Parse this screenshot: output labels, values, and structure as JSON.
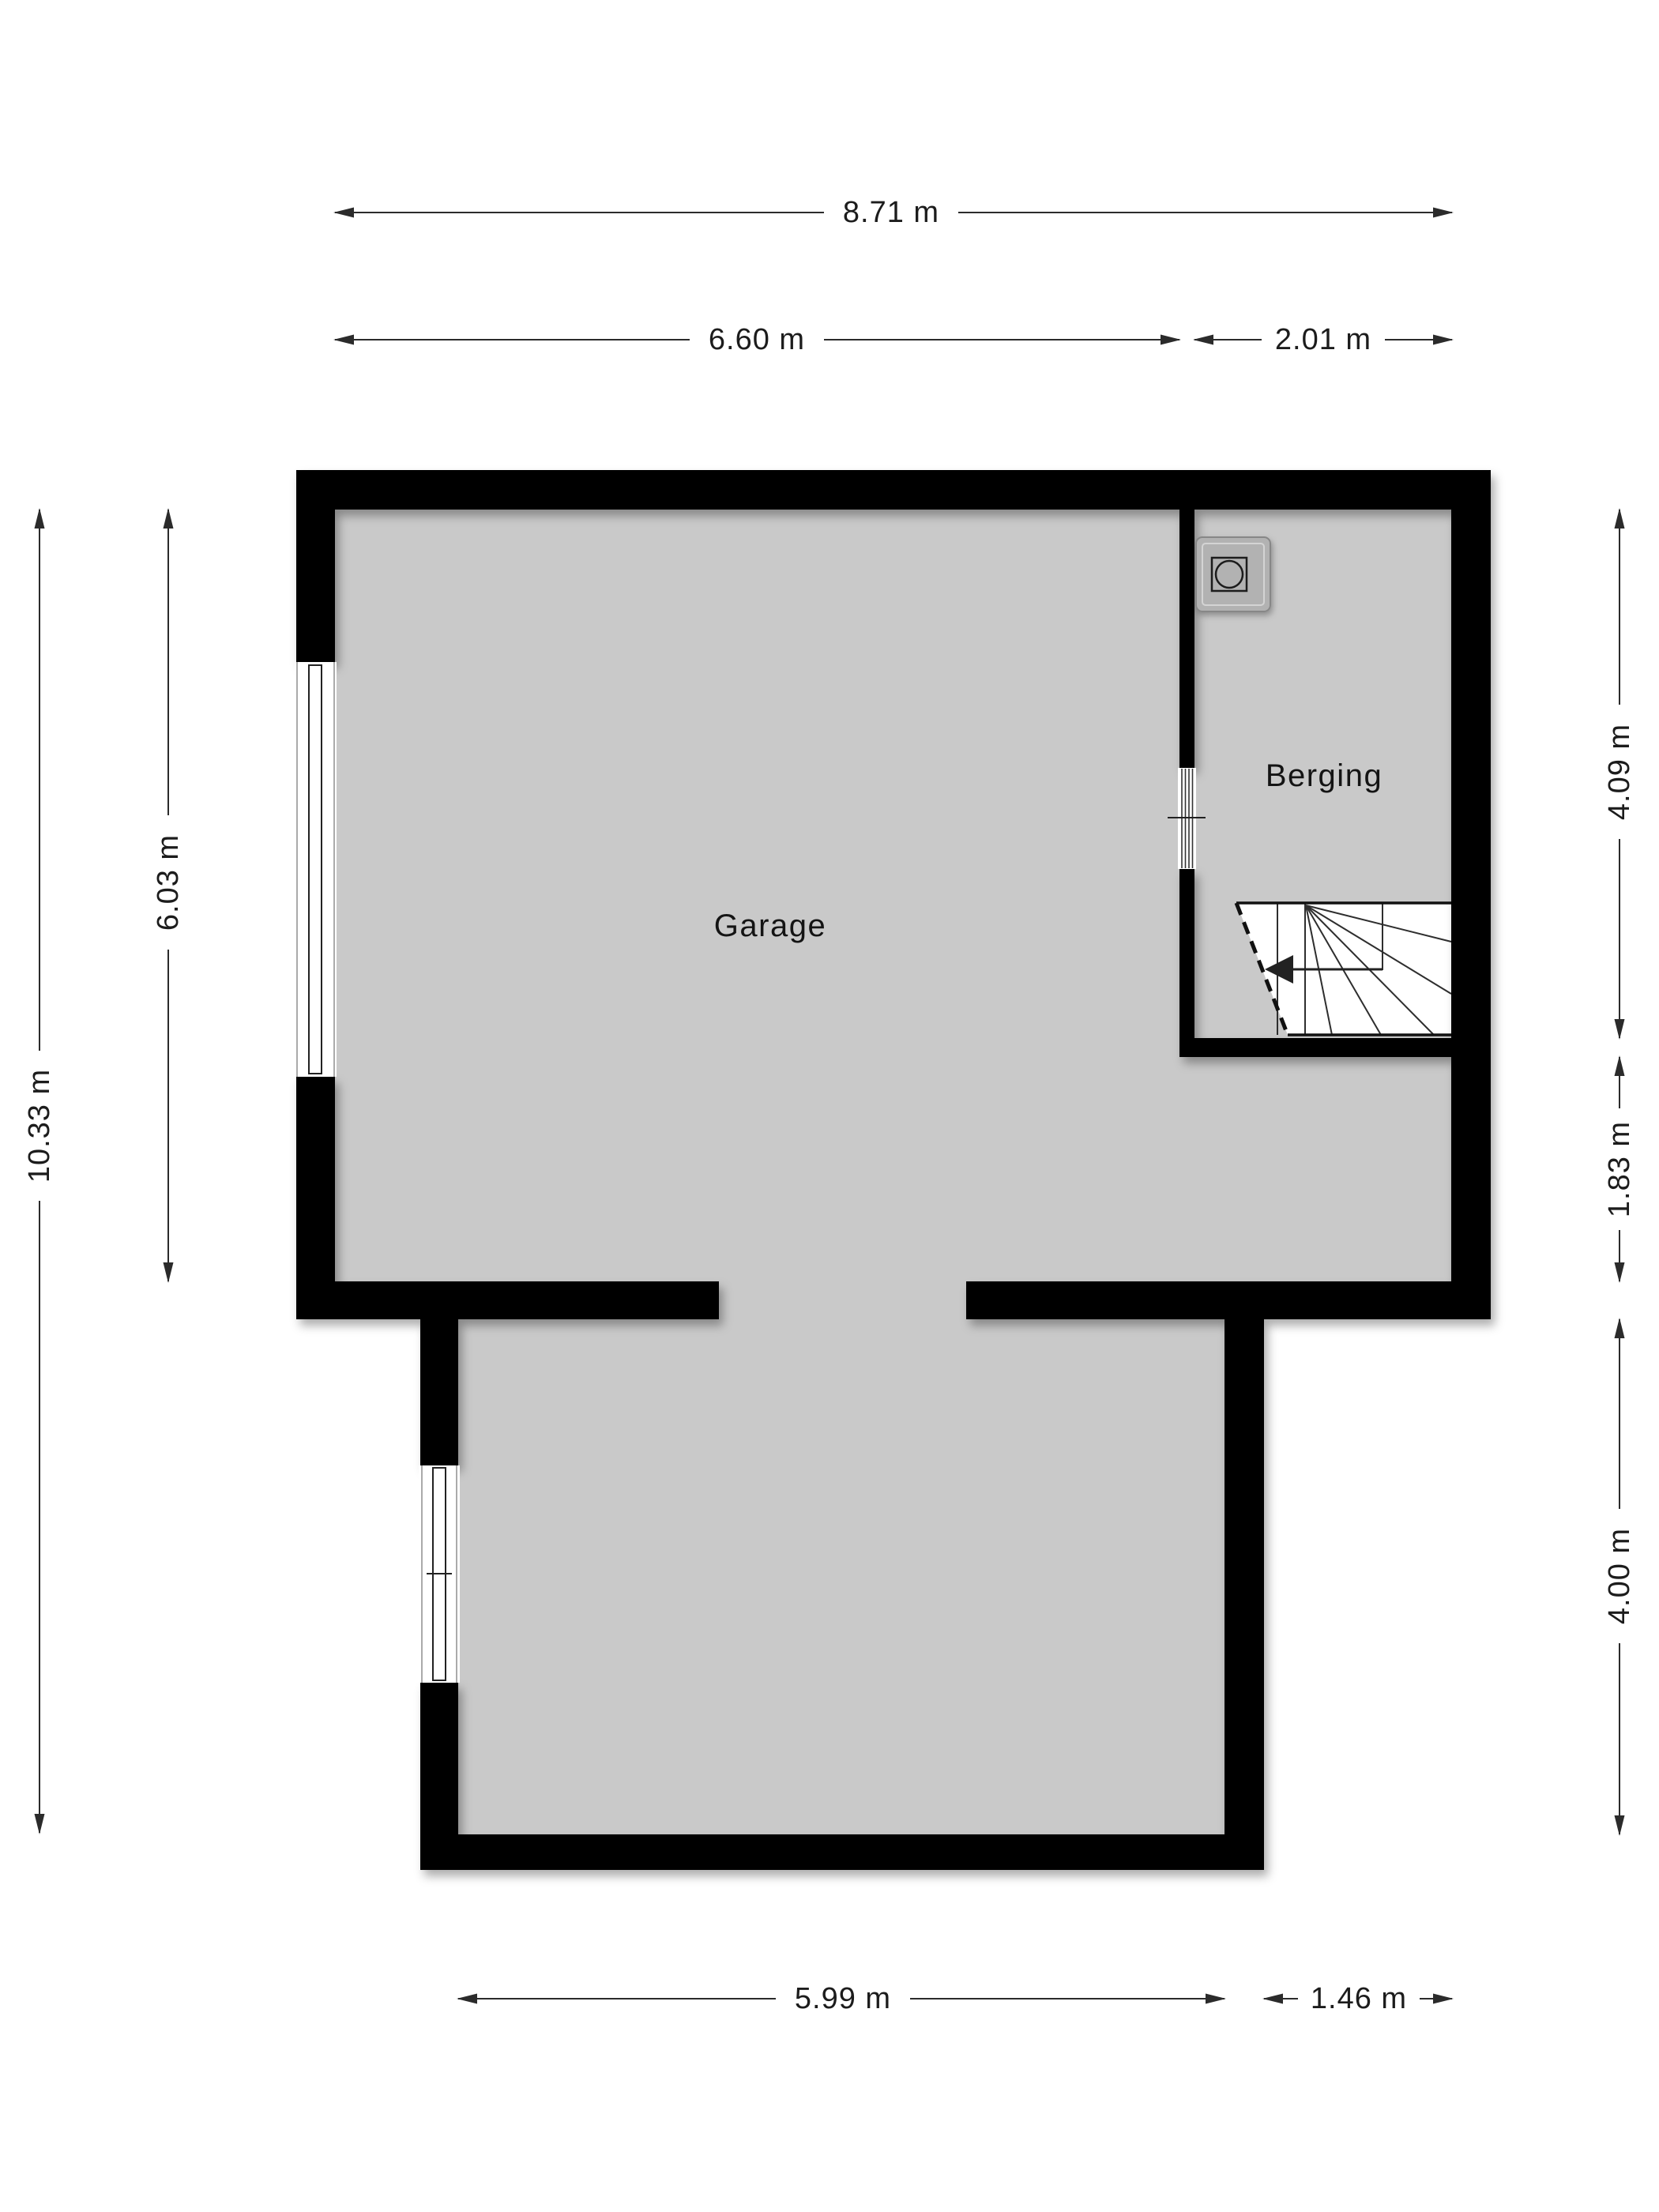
{
  "plan": {
    "type": "floorplan",
    "rooms": {
      "garage": {
        "label": "Garage"
      },
      "berging": {
        "label": "Berging"
      }
    },
    "dimensions": {
      "top_total": "8.71 m",
      "top_left": "6.60 m",
      "top_right": "2.01 m",
      "left_inner": "6.03 m",
      "left_total": "10.33 m",
      "right_top": "4.09 m",
      "right_mid": "1.83 m",
      "right_bottom": "4.00 m",
      "bottom_left": "5.99 m",
      "bottom_right": "1.46 m"
    },
    "icons": {
      "washer": "washing-machine-icon",
      "stairs": "staircase-icon",
      "stairs_arrow": "stair-direction-arrow-icon",
      "windows": "window-icon",
      "door": "door-opening-icon"
    },
    "colors": {
      "wall": "#000000",
      "floor": "#c9c9c9",
      "background": "#ffffff",
      "dimension_line": "#2b2b2b",
      "text": "#1c1c1c",
      "washer_fill": "#b2b2b2"
    }
  }
}
